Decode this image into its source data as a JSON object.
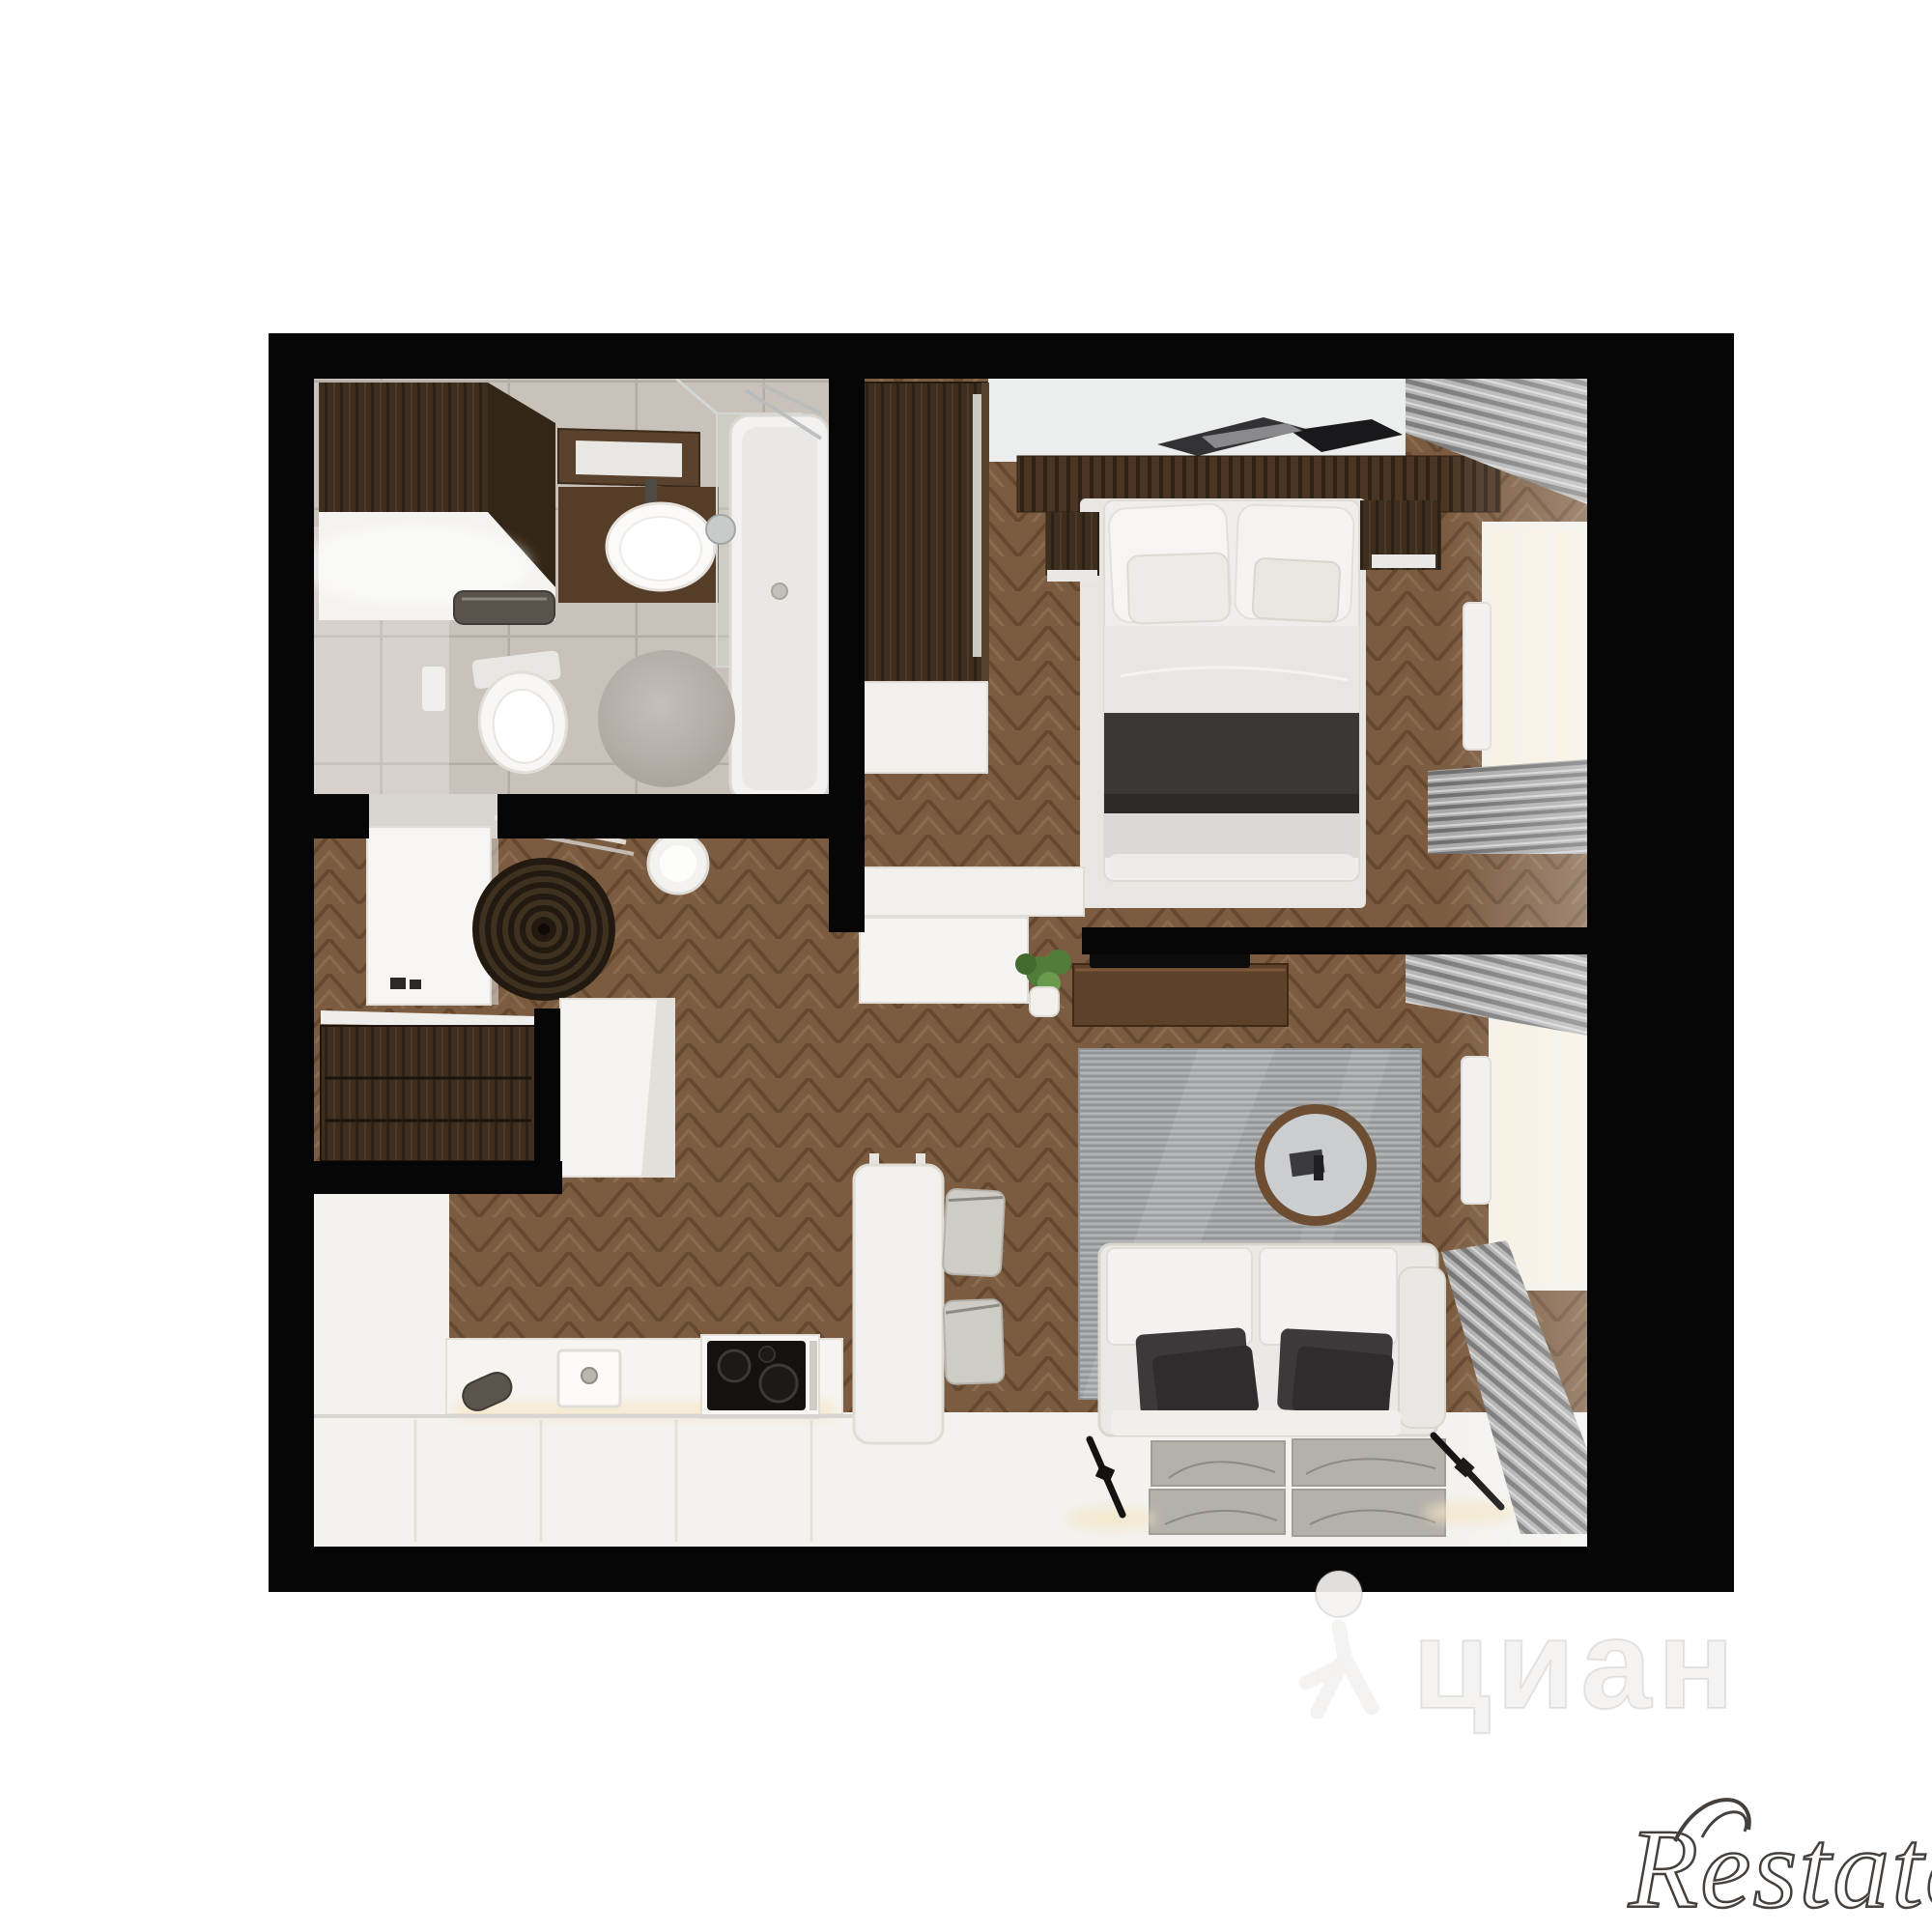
{
  "image": {
    "kind": "3d-floor-plan-render",
    "description": "Top-down 3D cutaway render of a one-bedroom apartment with bathroom, hallway, kitchen-living room and bedroom",
    "background": "#ffffff",
    "frame_color": "#070707"
  },
  "watermarks": {
    "cian": {
      "text": "циан",
      "icon": "person-walking-icon",
      "style": "faint translucent overlay, bottom-center-right"
    },
    "restate": {
      "text": "Restate",
      "style": "outlined italic serif logo, bottom-right corner, clipped at right edge"
    }
  },
  "palette": {
    "wall_black": "#070707",
    "wood_floor": "#7c5c40",
    "wood_dark_furniture": "#3e2e1e",
    "wood_slat_panel": "#4a3524",
    "bath_tile": "#c8c2bb",
    "tile_grout": "#b3ada6",
    "white_furniture": "#f4f3f1",
    "bed_dark_blanket": "#3a3837",
    "living_rug_gray": "#a2a4a5",
    "curtain_gray": "#8a8a8a",
    "window_glow": "#f7f0e2",
    "sconce_glow": "#f3e5c4",
    "plant_green": "#517d3a",
    "spiral_rug_dark": "#221a10"
  },
  "scene": {
    "rooms": [
      {
        "name": "bathroom",
        "position": "top-left",
        "items": [
          "wall cabinet",
          "vanity mirror",
          "countertop sink",
          "shower glass panel",
          "bathtub",
          "wall-hung toilet",
          "toilet paper holder",
          "towel bar",
          "round bath rug",
          "gray tile floor"
        ]
      },
      {
        "name": "bedroom",
        "position": "top-right",
        "items": [
          "wardrobe",
          "double bed with pillows and dark blanket",
          "wood slat headboard panel",
          "two nightstands",
          "wall art",
          "white dresser",
          "sliding door",
          "window with curtains",
          "radiator",
          "herringbone wood floor"
        ]
      },
      {
        "name": "hallway",
        "position": "middle-left",
        "items": [
          "open white door",
          "drying rack",
          "round spiral rug",
          "white stool",
          "dark wood console with drawers",
          "tall white cabinet"
        ]
      },
      {
        "name": "kitchen",
        "position": "bottom-left",
        "items": [
          "L-shaped white counter",
          "sink with faucet",
          "induction cooktop with oven",
          "under-cabinet lighting",
          "cabinet fronts"
        ]
      },
      {
        "name": "dining-area",
        "position": "bottom-center",
        "items": [
          "white dining table",
          "two gray chairs"
        ]
      },
      {
        "name": "living-room",
        "position": "bottom-right",
        "items": [
          "TV on black partition wall",
          "wood media console",
          "potted plant",
          "large gray rug",
          "round wood-framed coffee table",
          "two-seat light sofa with dark pillows",
          "four framed wall panels",
          "two black wall sconces with glow",
          "window with curtains",
          "radiator"
        ]
      }
    ]
  }
}
